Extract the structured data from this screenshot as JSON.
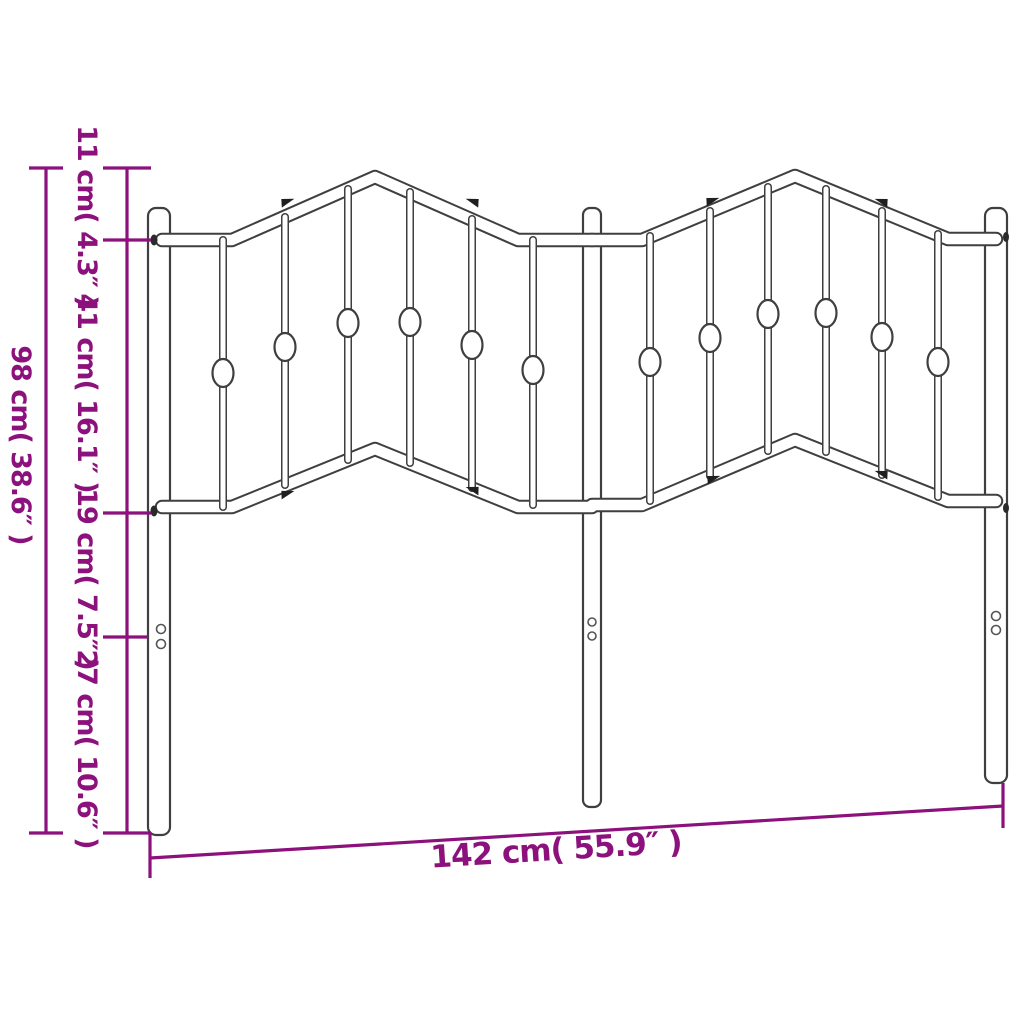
{
  "figure": {
    "type": "product dimension diagram",
    "subject": "metal headboard line drawing with two arched panels, three posts, spindles with oval accents",
    "colors": {
      "dimension_lines": "#8C117C",
      "line_art": "#3F3F3F",
      "background": "#FFFFFF"
    },
    "dimension_labels": {
      "total_height": "98 cm( 38.6″ )",
      "top_segment": "11 cm( 4.3″ )",
      "upper_panel_segment": "41 cm( 16.1″ )",
      "mid_segment": "19 cm( 7.5″ )",
      "lower_segment": "27 cm( 10.6″ )",
      "total_width": "142 cm( 55.9″ )"
    }
  }
}
